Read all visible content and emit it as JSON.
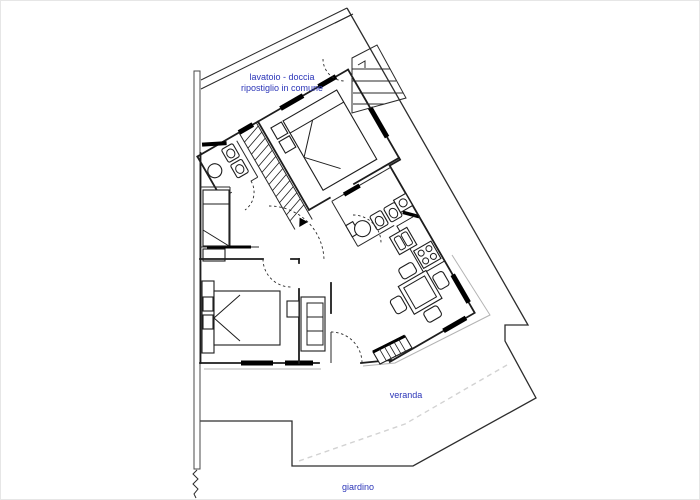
{
  "document": {
    "type": "architectural floor plan",
    "orientation": "apartment wing rotated ~30 degrees inside an irregular lot"
  },
  "labels": {
    "common_laundry_line1": "lavatoio - doccia",
    "common_laundry_line2": "ripostiglio in comune",
    "veranda": "veranda",
    "garden": "giardino"
  },
  "colors": {
    "label_text": "#2b35b8",
    "plan_lines": "#1d1d1d",
    "secondary_lines": "#b3b3b3",
    "dashed_property_line": "#d2d2d2",
    "background": "#ffffff"
  },
  "plan_symbols": [
    "double-bed",
    "single-bed",
    "hatched-staircase",
    "exterior-steps",
    "washbasin",
    "toilet",
    "bidet",
    "washing-machine",
    "kitchen-sink",
    "stove-4-burners",
    "dining-table-with-chairs",
    "sofa",
    "sideboard",
    "door-swing-arc",
    "window-bar",
    "property-boundary",
    "fence-squiggle"
  ]
}
